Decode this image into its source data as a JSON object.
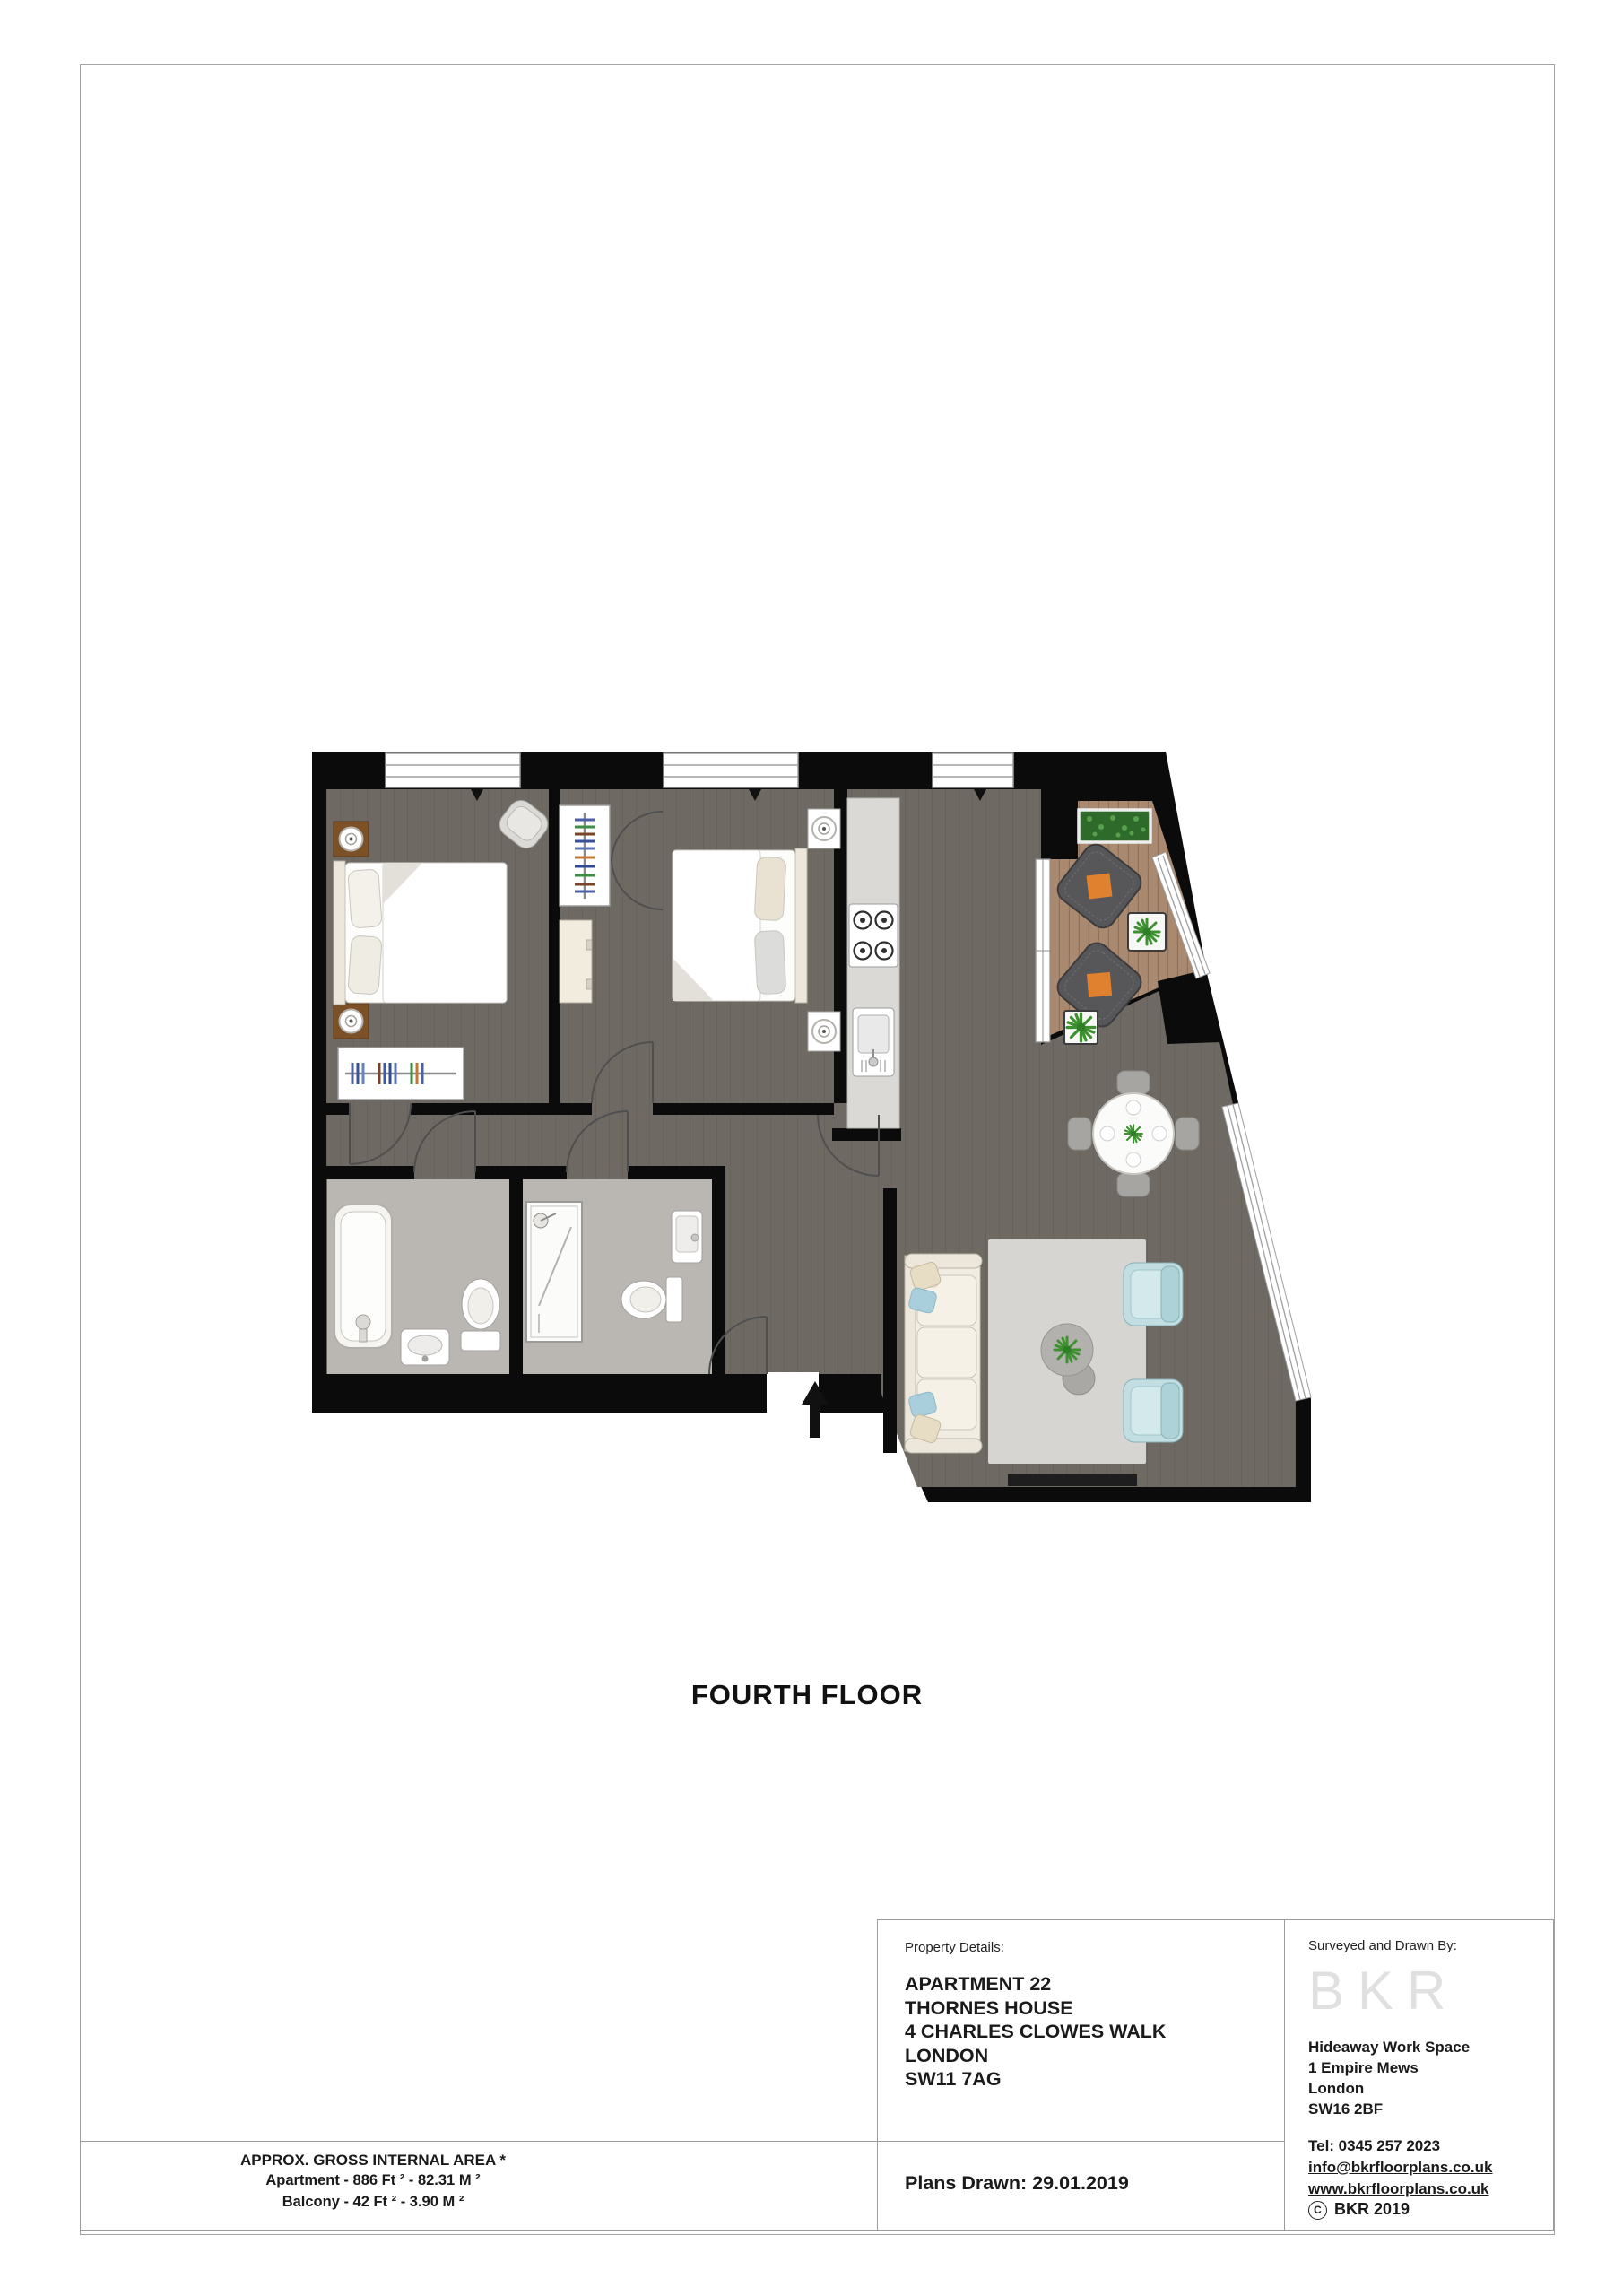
{
  "page": {
    "floor_label": "FOURTH FLOOR",
    "area_summary": {
      "title": "APPROX. GROSS INTERNAL AREA *",
      "apartment_line": "Apartment - 886 Ft ²  -  82.31 M ²",
      "balcony_line": "Balcony - 42 Ft ²  -  3.90 M ²"
    },
    "property_details": {
      "label": "Property Details:",
      "address_lines": [
        "APARTMENT 22",
        "THORNES HOUSE",
        "4 CHARLES CLOWES WALK",
        "LONDON",
        "SW11 7AG"
      ]
    },
    "plans_drawn": "Plans Drawn: 29.01.2019",
    "surveyor": {
      "label": "Surveyed and Drawn By:",
      "logo": "BKR",
      "address_lines": [
        "Hideaway Work Space",
        "1 Empire Mews",
        "London",
        "SW16 2BF"
      ],
      "tel": "Tel:  0345 257 2023",
      "email": "info@bkrfloorplans.co.uk",
      "website": "www.bkrfloorplans.co.uk",
      "copyright_symbol": "C",
      "copyright": "BKR 2019"
    }
  },
  "floorplan": {
    "colors": {
      "wall": "#0b0b0b",
      "floor": "#6f6963",
      "floorLine": "#5e5852",
      "bath": "#bab7b2",
      "deck": "#a9896f",
      "deckLine": "#8a6b53",
      "counter": "#dbd9d5",
      "rug": "#d7d5d1",
      "cream": "#ece7da",
      "sofa": "#f1ede3",
      "cushionBlue": "#a9cfdd",
      "cushionBeige": "#e7dcc4",
      "armchair": "#c2dee2",
      "wicker": "#57575a",
      "orange": "#e08130",
      "plant": "#3e9130",
      "doorArc": "#4f4f4f",
      "diningChair": "#a7a5a2",
      "glassLine": "#9f9f9f"
    }
  }
}
